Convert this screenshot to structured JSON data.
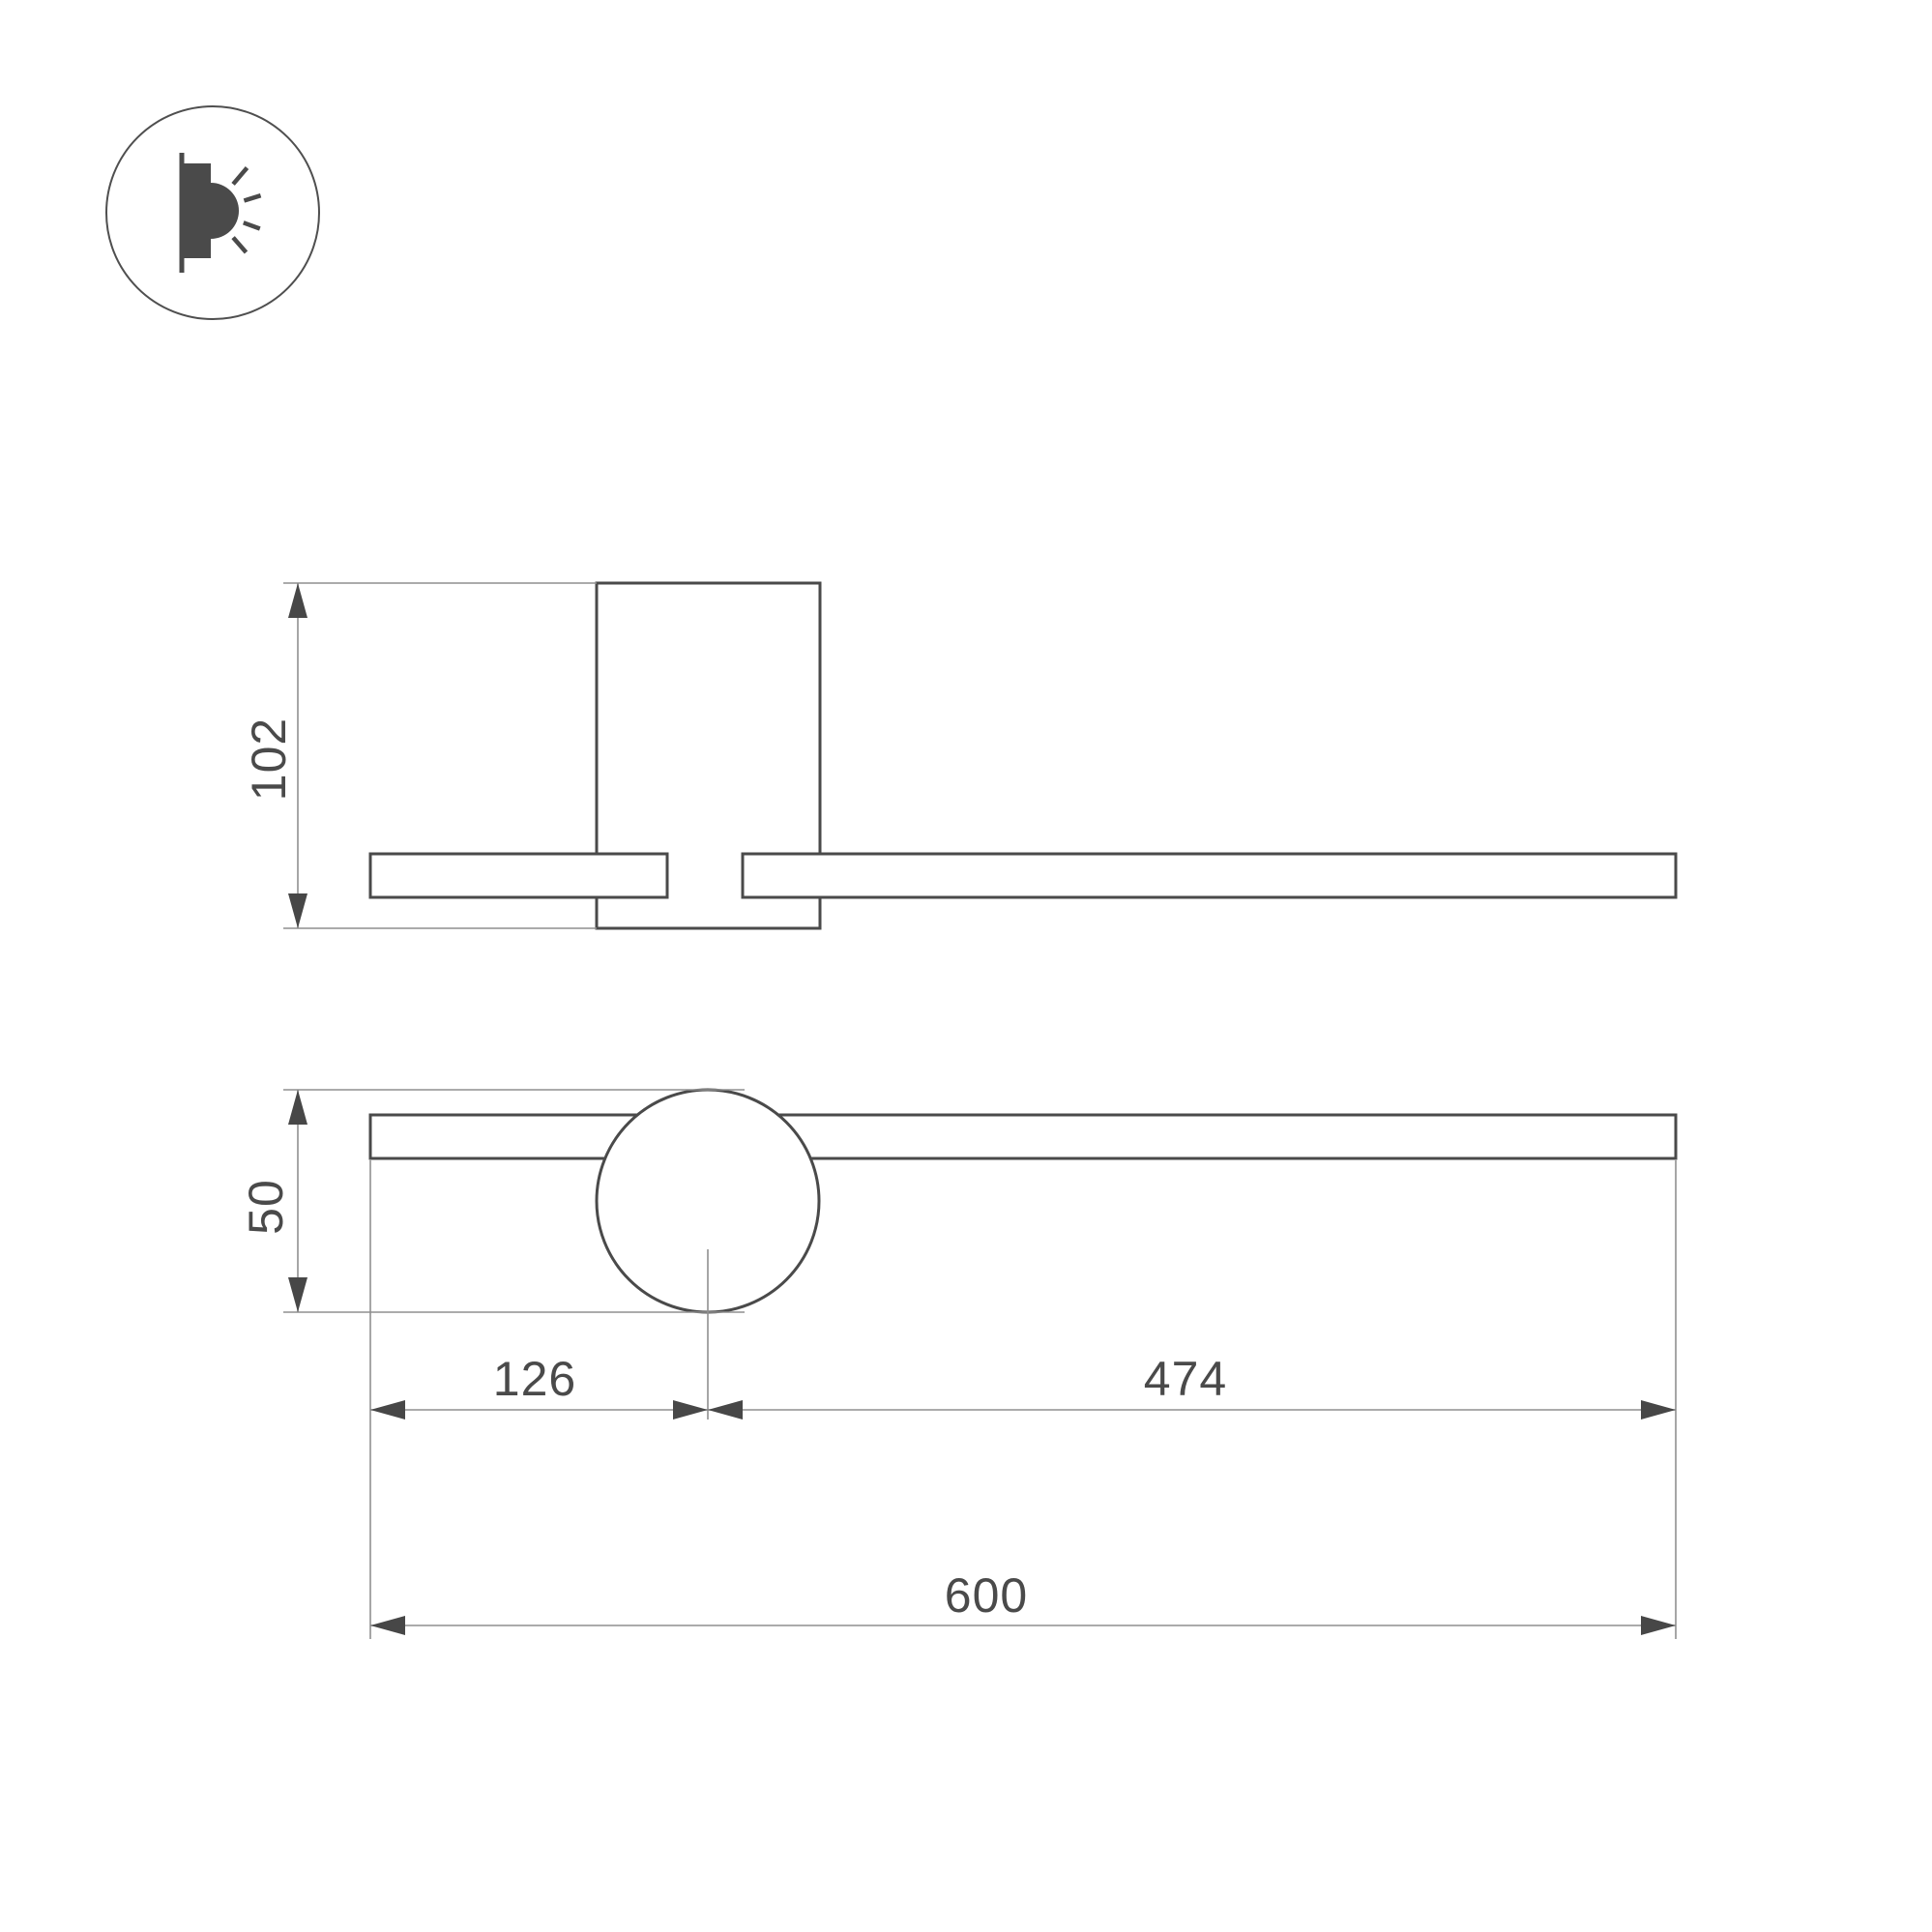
{
  "page": {
    "background": "#ffffff",
    "type": "technical-dimension-drawing"
  },
  "drawing": {
    "colors": {
      "outline": "#4a4a4a",
      "dimension_line": "#8f8f8f",
      "arrow": "#474747",
      "text": "#4a4a4a",
      "icon": "#4a4a4a",
      "icon_ring": "#4f4f4f"
    },
    "icon": {
      "name": "wall-mounted-light-icon"
    },
    "side_view": {
      "height_label": "102"
    },
    "front_view": {
      "height_label": "50",
      "left_offset_label": "126",
      "right_span_label": "474",
      "total_length_label": "600"
    }
  }
}
